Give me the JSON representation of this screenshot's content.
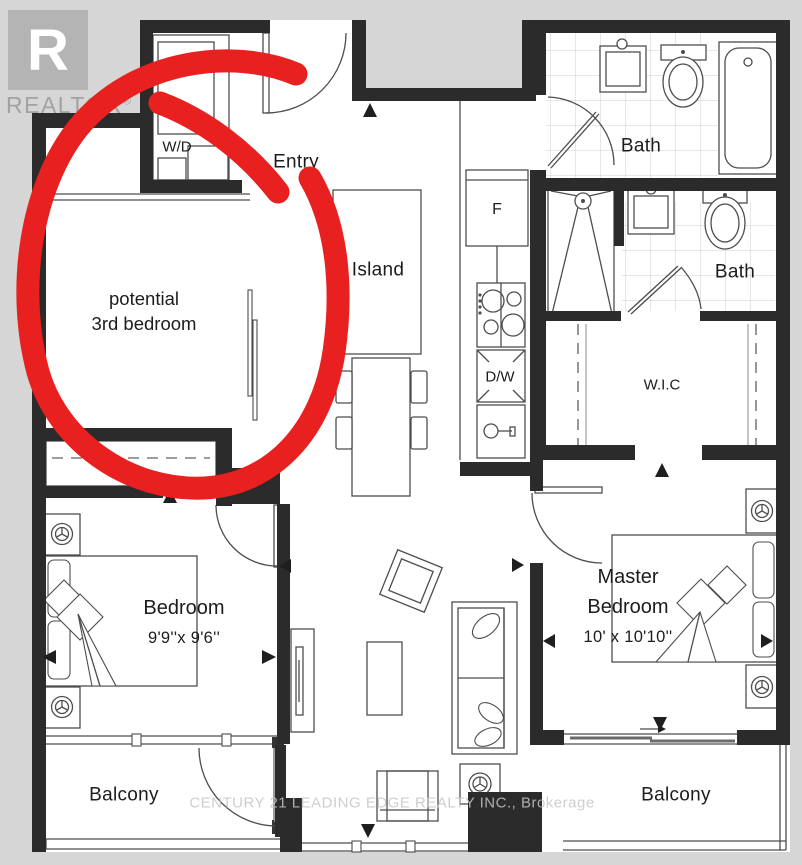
{
  "branding": {
    "logo_letter": "R",
    "logo_text": "REALTOR",
    "registered": "®",
    "watermark": "CENTURY 21 LEADING EDGE REALTY INC., Brokerage"
  },
  "annotation": {
    "line1": "potential",
    "line2": "3rd bedroom"
  },
  "labels": {
    "entry": "Entry",
    "island": "Island",
    "fridge": "F",
    "dishwasher": "D/W",
    "washer_dryer": "W/D",
    "bath_upper": "Bath",
    "bath_lower": "Bath",
    "wic": "W.I.C",
    "master": {
      "line1": "Master",
      "line2": "Bedroom",
      "dims": "10' x 10'10''"
    },
    "bedroom": {
      "name": "Bedroom",
      "dims": "9'9''x 9'6''"
    },
    "balcony_left": "Balcony",
    "balcony_right": "Balcony"
  },
  "colors": {
    "wall": "#2b2b2b",
    "background": "#d6d6d6",
    "floor": "#ffffff",
    "annotation_red": "#e8201f",
    "watermark_gray": "#a2a2a2"
  }
}
